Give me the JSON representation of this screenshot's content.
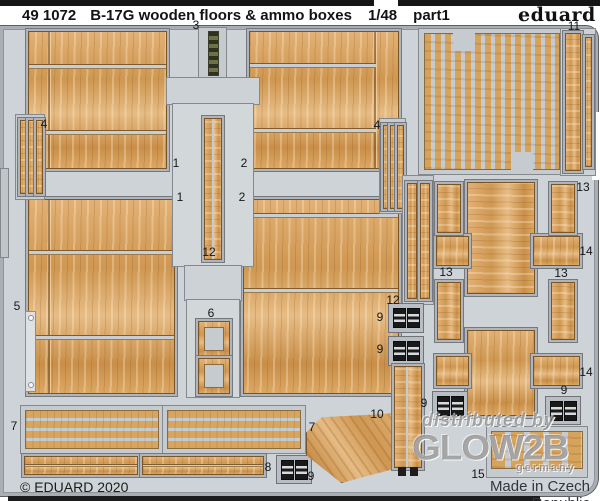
{
  "header": {
    "catalog_number": "49 1072",
    "title": "B-17G wooden floors & ammo boxes",
    "scale": "1/48",
    "part": "part1",
    "brand": "eduard"
  },
  "footer": {
    "copyright": "© EDUARD 2020",
    "made_in": "Made in Czech Republic"
  },
  "watermark": {
    "line1": "distributed by",
    "line2": "GLOW2B",
    "line3": "germany"
  },
  "colors": {
    "fret_gray": "#ced3d7",
    "rail_gray": "#a9aeb4",
    "wood_light": "#e2b176",
    "wood_dark": "#c98f49",
    "ammo_belt_green": "#6d7247",
    "clasp_black": "#191919",
    "top_bar_black": "#161616"
  },
  "part_labels": [
    {
      "text": "3",
      "x": 196,
      "y": 25
    },
    {
      "text": "1",
      "x": 176,
      "y": 163
    },
    {
      "text": "2",
      "x": 244,
      "y": 163
    },
    {
      "text": "1",
      "x": 180,
      "y": 197
    },
    {
      "text": "2",
      "x": 242,
      "y": 197
    },
    {
      "text": "4",
      "x": 44,
      "y": 124
    },
    {
      "text": "4",
      "x": 377,
      "y": 125
    },
    {
      "text": "5",
      "x": 17,
      "y": 306
    },
    {
      "text": "12",
      "x": 209,
      "y": 252
    },
    {
      "text": "6",
      "x": 211,
      "y": 313
    },
    {
      "text": "11",
      "x": 574,
      "y": 26
    },
    {
      "text": "13",
      "x": 583,
      "y": 187
    },
    {
      "text": "14",
      "x": 586,
      "y": 251
    },
    {
      "text": "13",
      "x": 446,
      "y": 272
    },
    {
      "text": "13",
      "x": 561,
      "y": 273
    },
    {
      "text": "12",
      "x": 393,
      "y": 300
    },
    {
      "text": "9",
      "x": 380,
      "y": 317
    },
    {
      "text": "9",
      "x": 380,
      "y": 349
    },
    {
      "text": "9",
      "x": 424,
      "y": 403
    },
    {
      "text": "9",
      "x": 564,
      "y": 390
    },
    {
      "text": "14",
      "x": 586,
      "y": 372
    },
    {
      "text": "10",
      "x": 377,
      "y": 414
    },
    {
      "text": "7",
      "x": 14,
      "y": 426
    },
    {
      "text": "7",
      "x": 312,
      "y": 427
    },
    {
      "text": "8",
      "x": 268,
      "y": 467
    },
    {
      "text": "9",
      "x": 311,
      "y": 476
    },
    {
      "text": "15",
      "x": 478,
      "y": 474
    }
  ]
}
